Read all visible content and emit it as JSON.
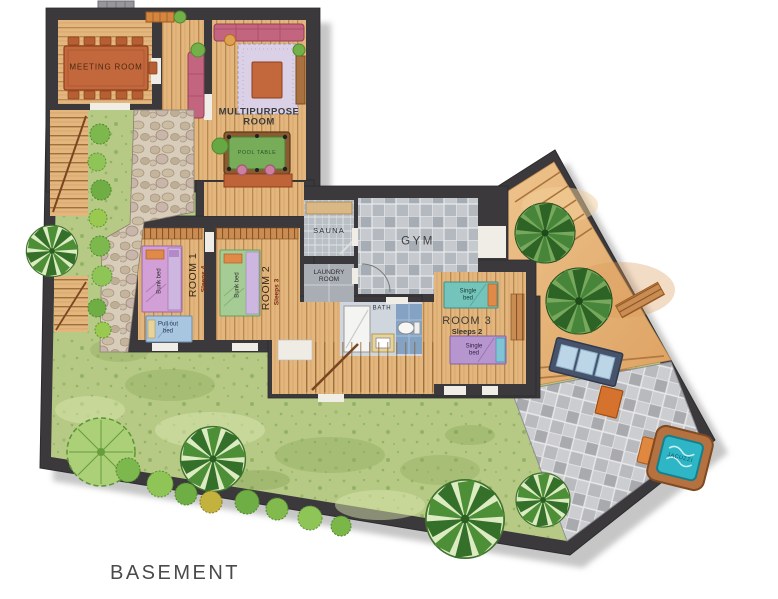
{
  "floor_label": "BASEMENT",
  "rooms": {
    "meeting": {
      "label": "MEETING ROOM"
    },
    "multipurpose": {
      "label": "MULTIPURPOSE ROOM",
      "pool_table": "POOL TABLE"
    },
    "sauna": {
      "label": "SAUNA"
    },
    "gym": {
      "label": "GYM"
    },
    "laundry": {
      "label": "LAUNDRY ROOM"
    },
    "bath": {
      "label": "BATH"
    },
    "room1": {
      "label": "ROOM 1",
      "sleeps": "Sleeps 4",
      "bunk_bed": "Bunk bed",
      "pullout_bed": "Pull out bed"
    },
    "room2": {
      "label": "ROOM 2",
      "sleeps": "Sleeps 3",
      "bunk_bed": "Bunk bed"
    },
    "room3": {
      "label": "ROOM 3",
      "sleeps": "Sleeps 2",
      "single_bed": "Single bed"
    },
    "jacuzzi": {
      "label": "JACUZZI"
    }
  },
  "colors": {
    "wall": "#3b393c",
    "wood": "#e3b67d",
    "lawn": "#b6ca85",
    "sand": "#e7b77c",
    "gym_tile": "#b3b9bf",
    "patio_tile": "#bcbdc1",
    "water": "#2fb6c6",
    "accent_orange": "#d4722e"
  }
}
